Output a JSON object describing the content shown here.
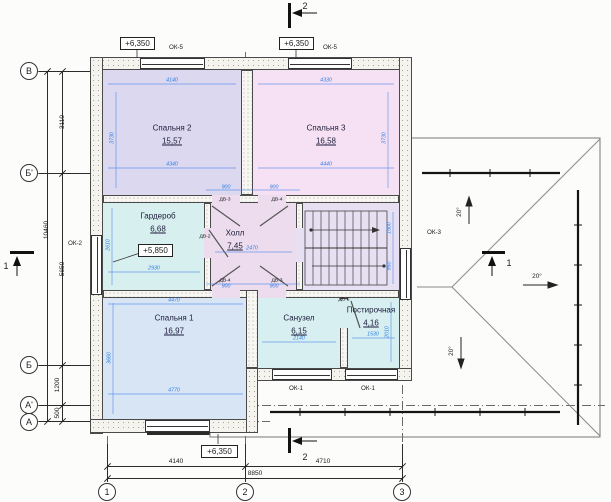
{
  "axes": {
    "horizontal": [
      {
        "label": "В"
      },
      {
        "label": "Б'"
      },
      {
        "label": "Б"
      },
      {
        "label": "А'"
      },
      {
        "label": "А"
      }
    ],
    "vertical": [
      {
        "label": "1"
      },
      {
        "label": "2"
      },
      {
        "label": "3"
      }
    ]
  },
  "dimensions": {
    "left_between_1": "3110",
    "left_between_2": "5650",
    "left_between_3": "1200",
    "left_between_4": "500",
    "left_total": "10460",
    "bottom_between_1": "4140",
    "bottom_between_2": "4710",
    "bottom_total": "8850"
  },
  "elevations": {
    "top_left": "+6,350",
    "top_right": "+6,350",
    "bottom": "+6,350",
    "wardrobe": "+5,850"
  },
  "rooms": {
    "bedroom2": {
      "name": "Спальня 2",
      "area": "15,57"
    },
    "bedroom3": {
      "name": "Спальня 3",
      "area": "16,58"
    },
    "wardrobe": {
      "name": "Гардероб",
      "area": "6,68"
    },
    "hall": {
      "name": "Холл",
      "area": "7,45"
    },
    "bedroom1": {
      "name": "Спальня 1",
      "area": "16,97"
    },
    "bathroom": {
      "name": "Санузел",
      "area": "6,15"
    },
    "laundry": {
      "name": "Постирочная",
      "area": "4,16"
    }
  },
  "windows": {
    "ok5a": "ОК-5",
    "ok5b": "ОК-5",
    "ok2": "ОК-2",
    "ok3": "ОК-3",
    "ok1a": "ОК-1",
    "ok1b": "ОК-1"
  },
  "doors": {
    "dv3a": "ДВ-3",
    "dv4a": "ДВ-4",
    "dv2": "ДВ-2",
    "dv4b": "ДВ-4",
    "dv3b": "ДВ-3",
    "dv5": "ДВ-5"
  },
  "sections": {
    "s1": "1",
    "s2_top": "2",
    "s2_bottom": "2"
  },
  "roof": {
    "slope_up": "20°",
    "slope_down": "20°",
    "slope_right": "20°"
  },
  "inner_dims": [
    {
      "x": 172,
      "y": 80,
      "rot": "h",
      "v": "4140"
    },
    {
      "x": 172,
      "y": 164,
      "rot": "h",
      "v": "4340"
    },
    {
      "x": 112,
      "y": 138,
      "rot": "v",
      "v": "3730"
    },
    {
      "x": 326,
      "y": 80,
      "rot": "h",
      "v": "4330"
    },
    {
      "x": 326,
      "y": 164,
      "rot": "h",
      "v": "4440"
    },
    {
      "x": 384,
      "y": 138,
      "rot": "v",
      "v": "3730"
    },
    {
      "x": 154,
      "y": 268,
      "rot": "h",
      "v": "2930"
    },
    {
      "x": 108,
      "y": 245,
      "rot": "v",
      "v": "2610"
    },
    {
      "x": 252,
      "y": 248,
      "rot": "h",
      "v": "2470"
    },
    {
      "x": 174,
      "y": 300,
      "rot": "h",
      "v": "4470"
    },
    {
      "x": 174,
      "y": 390,
      "rot": "h",
      "v": "4770"
    },
    {
      "x": 109,
      "y": 358,
      "rot": "v",
      "v": "3660"
    },
    {
      "x": 299,
      "y": 338,
      "rot": "h",
      "v": "2140"
    },
    {
      "x": 373,
      "y": 334,
      "rot": "h",
      "v": "1530"
    },
    {
      "x": 387,
      "y": 332,
      "rot": "v",
      "v": "2010"
    },
    {
      "x": 226,
      "y": 187,
      "rot": "h",
      "v": "900"
    },
    {
      "x": 274,
      "y": 187,
      "rot": "h",
      "v": "900"
    },
    {
      "x": 226,
      "y": 286,
      "rot": "h",
      "v": "900"
    },
    {
      "x": 274,
      "y": 286,
      "rot": "h",
      "v": "900"
    },
    {
      "x": 389,
      "y": 228,
      "rot": "v",
      "v": "1500"
    },
    {
      "x": 389,
      "y": 266,
      "rot": "v",
      "v": "950"
    }
  ],
  "colors": {
    "bedroom2": "#dbd8f0",
    "bedroom3": "#f6e1f4",
    "wardrobe": "#d7efee",
    "hall": "#ecdcee",
    "stairs": "#e7e0f2",
    "bedroom1": "#d8e5f5",
    "bathroom": "#d7eff1",
    "laundry": "#d7eff1",
    "dim_blue": "#2e7de5"
  }
}
